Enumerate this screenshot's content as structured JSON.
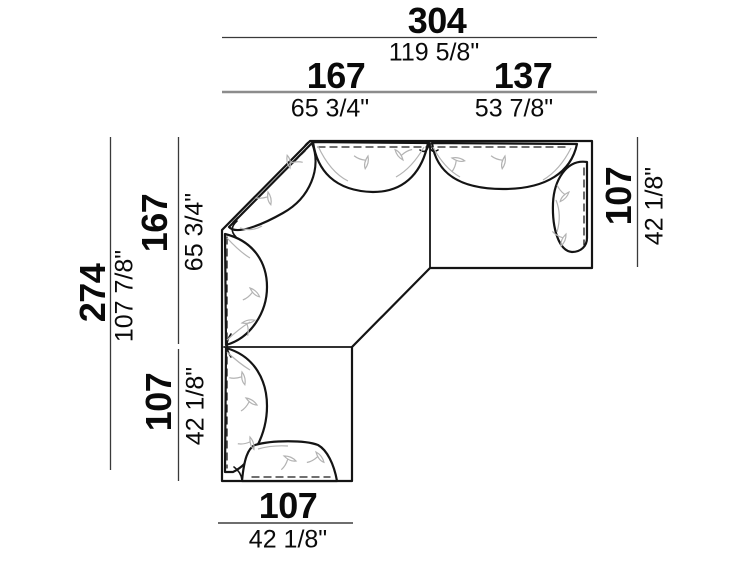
{
  "diagram": {
    "title": "sectional-corner-sofa-top-view-dimension-drawing",
    "units": {
      "primary": "cm",
      "secondary": "inches"
    },
    "colors": {
      "background": "#ffffff",
      "sofa_line": "#141414",
      "dim_line": "#3a3a3a",
      "dim_line_secondary": "#8c8c8c",
      "wrinkle_line": "#b3b3b3",
      "text": "#0a0a0a"
    },
    "dimensions": {
      "top_total": {
        "cm": "304",
        "in": "119 5/8\""
      },
      "top_left_module": {
        "cm": "167",
        "in": "65 3/4\""
      },
      "top_right_module": {
        "cm": "137",
        "in": "53 7/8\""
      },
      "left_total": {
        "cm": "274",
        "in": "107 7/8\""
      },
      "left_upper_module": {
        "cm": "167",
        "in": "65 3/4\""
      },
      "left_lower_module": {
        "cm": "107",
        "in": "42 1/8\""
      },
      "right_module": {
        "cm": "107",
        "in": "42 1/8\""
      },
      "bottom_module": {
        "cm": "107",
        "in": "42 1/8\""
      }
    }
  }
}
